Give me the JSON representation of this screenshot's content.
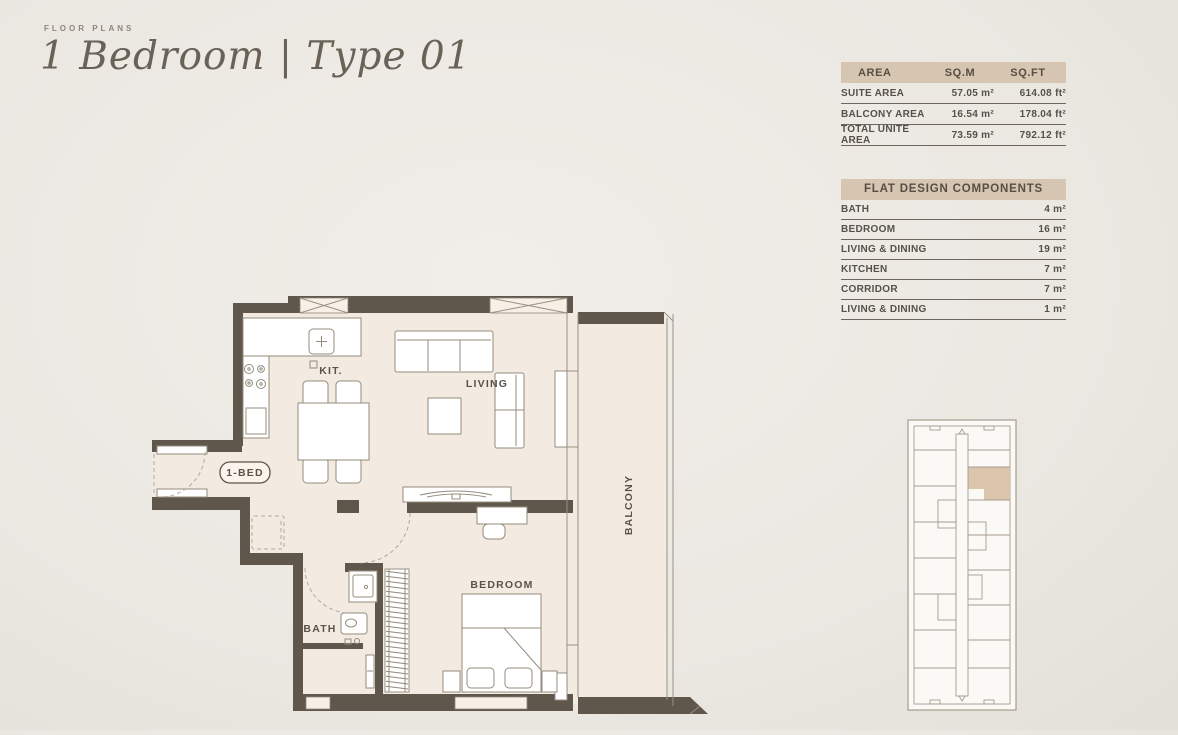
{
  "header": {
    "eyebrow": "FLOOR PLANS",
    "title": "1 Bedroom | Type 01"
  },
  "area_table": {
    "headers": [
      "AREA",
      "SQ.M",
      "SQ.FT"
    ],
    "rows": [
      {
        "label": "SUITE AREA",
        "sqm": "57.05 m²",
        "sqft": "614.08 ft²"
      },
      {
        "label": "BALCONY AREA",
        "sqm": "16.54 m²",
        "sqft": "178.04 ft²"
      },
      {
        "label": "TOTAL UNITE AREA",
        "sqm": "73.59 m²",
        "sqft": "792.12 ft²"
      }
    ]
  },
  "components_table": {
    "title": "FLAT DESIGN COMPONENTS",
    "rows": [
      {
        "label": "BATH",
        "value": "4 m²"
      },
      {
        "label": "BEDROOM",
        "value": "16 m²"
      },
      {
        "label": "LIVING & DINING",
        "value": "19 m²"
      },
      {
        "label": "KITCHEN",
        "value": "7 m²"
      },
      {
        "label": "CORRIDOR",
        "value": "7 m²"
      },
      {
        "label": "LIVING & DINING",
        "value": "1 m²"
      }
    ]
  },
  "floorplan_labels": {
    "kitchen": "KIT.",
    "living": "LIVING",
    "unit": "1-BED",
    "bath": "BATH",
    "bedroom": "BEDROOM",
    "balcony": "BALCONY"
  },
  "colors": {
    "background": "#ebe8e2",
    "table_header_bar": "#d5c5b1",
    "wall": "#5f574b",
    "floor_fill": "#f3eae1",
    "text": "#5b5349",
    "keyplan_highlight": "#dbc5ad"
  }
}
